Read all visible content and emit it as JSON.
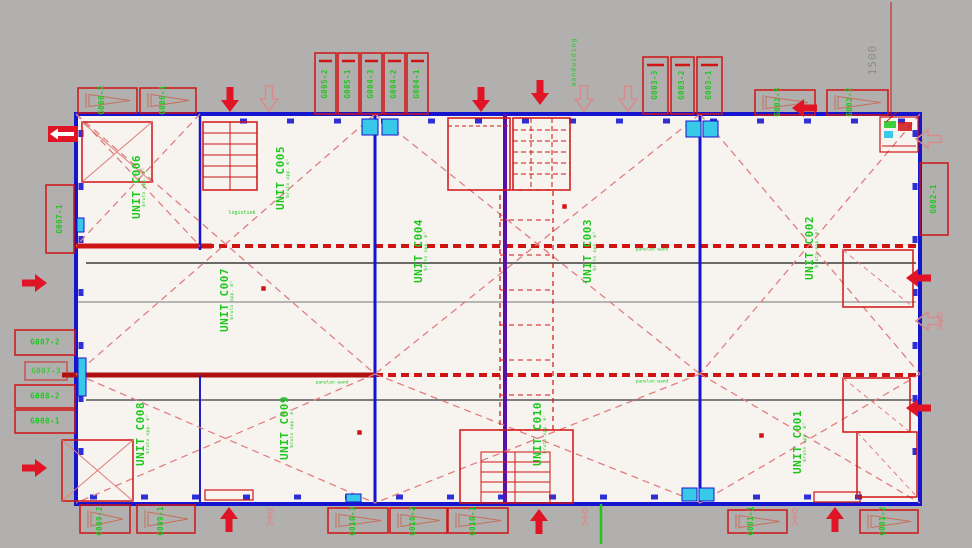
{
  "colors": {
    "background": "#b1b0ae",
    "paper": "#f7f4f0",
    "wall_blue": "#1515cf",
    "wall_purple": "#5a10a8",
    "line_red": "#cf1414",
    "dash_red": "#e17d7d",
    "text_green": "#1fc71f",
    "door_cyan": "#38c9e9",
    "dim_gray": "#8c8c8a",
    "arrow_red": "#e01424"
  },
  "dimension_label": "1500",
  "notes": {
    "vertical_note": "aanduiding",
    "stair_note": "logistiek",
    "wall_note_1": "panelen wand",
    "wall_note_2": "panelen wand",
    "wall_note_3": "panelen wand"
  },
  "units": [
    {
      "label": "UNIT C001",
      "sub": "bruto opp. m²"
    },
    {
      "label": "UNIT C002",
      "sub": "bruto opp. m²"
    },
    {
      "label": "UNIT C003",
      "sub": "bruto opp. m²"
    },
    {
      "label": "UNIT C004",
      "sub": "bruto opp. m²"
    },
    {
      "label": "UNIT C005",
      "sub": "bruto opp. m²"
    },
    {
      "label": "UNIT C006",
      "sub": "bruto opp. m²"
    },
    {
      "label": "UNIT C007",
      "sub": "bruto opp. m²"
    },
    {
      "label": "UNIT C008",
      "sub": "bruto opp. m²"
    },
    {
      "label": "UNIT C009",
      "sub": "bruto opp. m²"
    },
    {
      "label": "UNIT C010",
      "sub": "bruto opp. m²"
    }
  ],
  "vent_labels": {
    "top_left": [
      "G006-2",
      "G006-1"
    ],
    "top_mid": [
      "G005-2",
      "G005-1",
      "G004-3",
      "G004-2",
      "G004-1"
    ],
    "top_right_stack": [
      "G003-3",
      "G003-2",
      "G003-1"
    ],
    "top_right_pair": [
      "G002-3",
      "G002-2"
    ],
    "right_edge": "G002-1",
    "left_edge": "G007-1",
    "left_stack": [
      "G007-2",
      "G007-3",
      "G008-2",
      "G008-1"
    ],
    "bottom_left": [
      "G009-2",
      "G009-1"
    ],
    "bottom_mid": [
      "G010-3",
      "G010-2",
      "G010-1"
    ],
    "bottom_right": [
      "G001-1",
      "G001-2"
    ]
  }
}
